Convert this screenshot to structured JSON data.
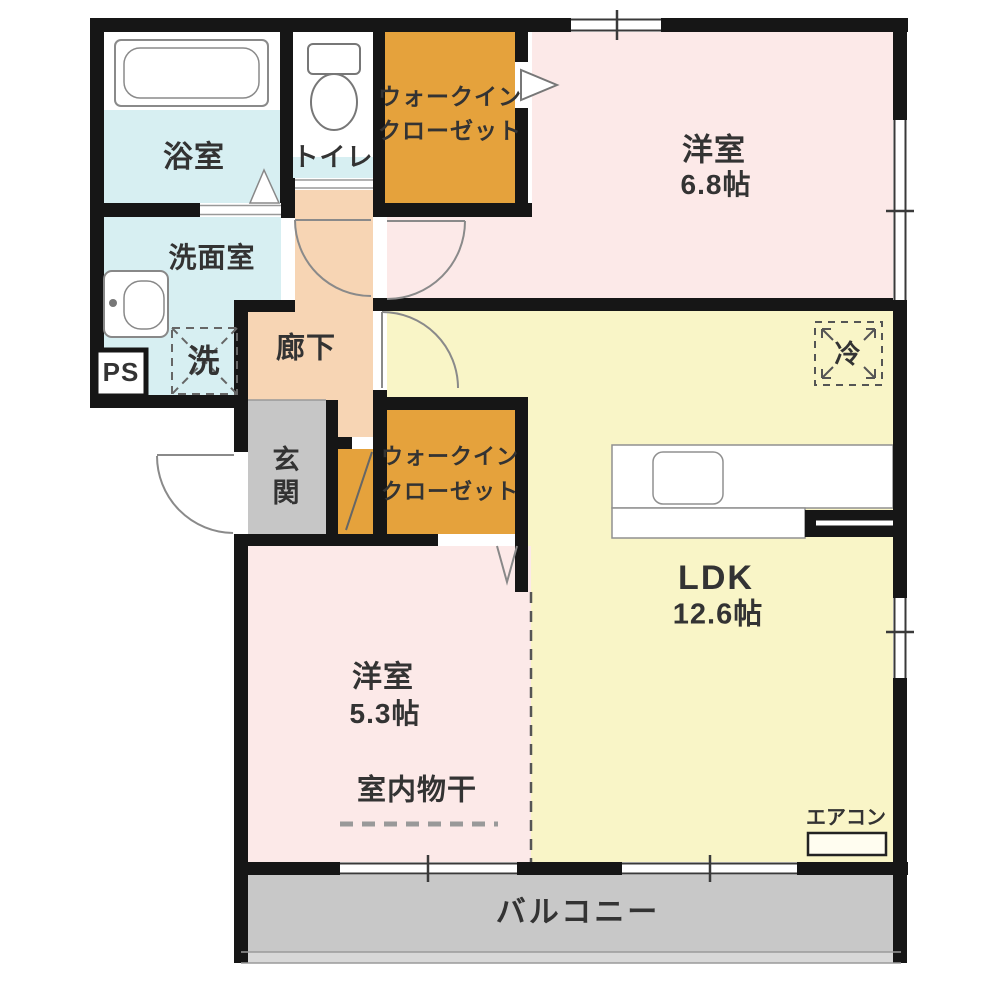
{
  "rooms": {
    "bedroom_68": {
      "name": "洋室",
      "size": "6.8帖"
    },
    "wic_top": {
      "name_line1": "ウォークイン",
      "name_line2": "クローゼット"
    },
    "toilet": {
      "name": "トイレ"
    },
    "bathroom": {
      "name": "浴室"
    },
    "washroom": {
      "name": "洗面室"
    },
    "hallway": {
      "name": "廊下"
    },
    "genkan": {
      "name": "玄関"
    },
    "wic_middle": {
      "name_line1": "ウォークイン",
      "name_line2": "クローゼット"
    },
    "ldk": {
      "name": "LDK",
      "size": "12.6帖"
    },
    "bedroom_53": {
      "name": "洋室",
      "size": "5.3帖"
    },
    "balcony": {
      "name": "バルコニー"
    }
  },
  "annotations": {
    "indoor_drying": "室内物干",
    "air_conditioner": "エアコン",
    "refrigerator": "冷",
    "washer": "洗",
    "pipe_space": "PS"
  },
  "colors": {
    "wall": "#161616",
    "bathroom_cyan": "#d7eff2",
    "hallway_peach": "#f7d5b4",
    "wic_orange": "#e5a23c",
    "bedroom_pink": "#fce9e8",
    "ldk_yellow": "#f9f5c7",
    "genkan_gray": "#c6c6c6",
    "balcony_gray": "#c8c8c8",
    "balcony_lip_gray": "#d8d8d8"
  }
}
